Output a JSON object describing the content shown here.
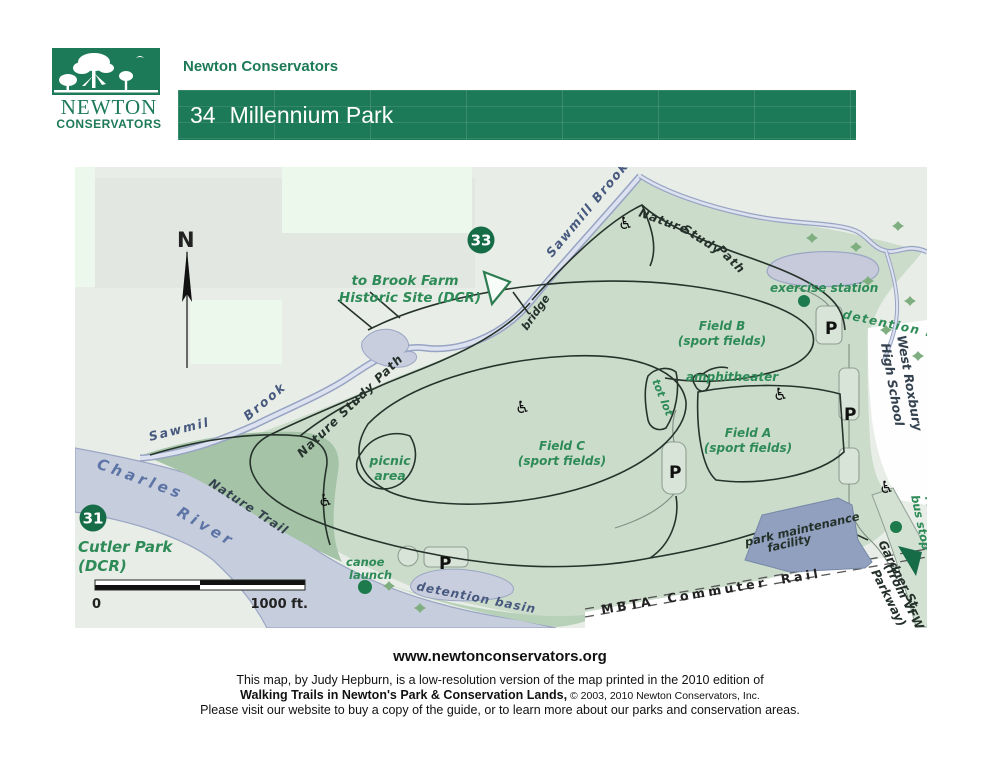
{
  "header": {
    "org_name": "Newton Conservators",
    "logo": {
      "line1": "NEWTON",
      "line2": "CONSERVATORS"
    },
    "banner": {
      "number": "34",
      "title": "Millennium Park"
    }
  },
  "colors": {
    "brand_green": "#1d7a58",
    "label_green": "#2e8b57",
    "park_green": "#cbdccb",
    "water_fill": "#c6cddc",
    "building_fill": "#91a0bf",
    "badge_green": "#156c47"
  },
  "map": {
    "north_label": "N",
    "badges": {
      "brook_farm": "33",
      "cutler_park": "31"
    },
    "scale": {
      "start": "0",
      "end": "1000 ft."
    },
    "labels": {
      "sawmill_brook_top": "Sawmill  Brook",
      "nsp_word1": "Nature",
      "nsp_word2": "Study",
      "nsp_word3": "Path",
      "nature_study_path_left": "Nature  Study  Path",
      "to_brook_farm_1": "to  Brook  Farm",
      "to_brook_farm_2": "Historic  Site  (DCR)",
      "bridge": "bridge",
      "exercise_station": "exercise station",
      "detention_basin_ne": "detention  basin",
      "field_b_1": "Field B",
      "field_b_2": "(sport fields)",
      "amphitheater": "amphitheater",
      "tot_lot": "tot lot",
      "field_a_1": "Field A",
      "field_a_2": "(sport  fields)",
      "field_c_1": "Field  C",
      "field_c_2": "(sport fields)",
      "picnic_1": "picnic",
      "picnic_2": "area",
      "west_roxbury_1": "West Roxbury",
      "west_roxbury_2": "High School",
      "mbta_bus_1": "MBTA",
      "mbta_bus_2": "bus stop",
      "sawmil_left_1": "Sawmil",
      "sawmil_left_2": "Brook",
      "charles_1": "Charles",
      "charles_2": "River",
      "nature_trail": "Nature Trail",
      "cutler_1": "Cutler Park",
      "cutler_2": "(DCR)",
      "canoe_1": "canoe",
      "canoe_2": "launch",
      "detention_basin_s": "detention basin",
      "mbta_rail": "MBTA  Commuter  Rail",
      "park_maint_1": "park  maintenance",
      "park_maint_2": "facility",
      "gardner_st": "Gardner St.",
      "vfw_1": "(from VFW",
      "vfw_2": "Parkway)",
      "parking": "P"
    }
  },
  "footer": {
    "website": "www.newtonconservators.org",
    "line1": "This map, by Judy Hepburn, is a low-resolution version of the map printed in the 2010 edition of",
    "line2_bold": "Walking Trails in Newton's Park & Conservation Lands,",
    "line2_rest": " © 2003, 2010 Newton Conservators, Inc.",
    "line3": "Please visit our website to buy a copy of the guide, or to learn more about our parks and conservation areas."
  }
}
